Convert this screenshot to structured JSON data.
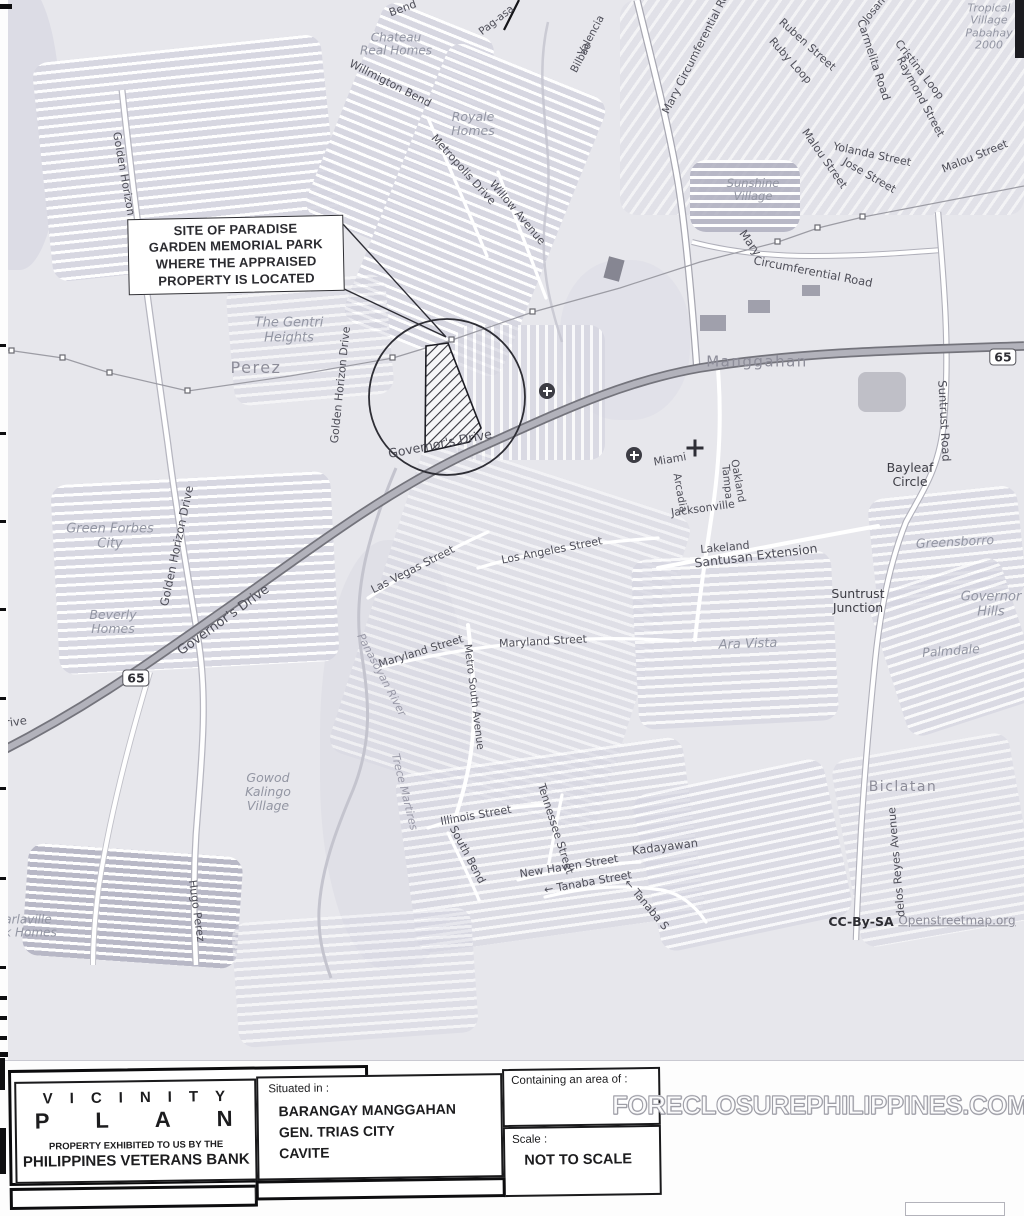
{
  "map": {
    "callout": {
      "lines": [
        "SITE OF PARADISE",
        "GARDEN MEMORIAL PARK",
        "WHERE THE APPRAISED",
        "PROPERTY IS LOCATED"
      ]
    },
    "labels": [
      {
        "t": "Bend",
        "x": 403,
        "y": 9,
        "r": -20,
        "s": 11,
        "c": "st"
      },
      {
        "t": "Chateau\nReal Homes",
        "x": 396,
        "y": 45,
        "r": 0,
        "s": 12,
        "c": "vil"
      },
      {
        "t": "Willmigton Bend",
        "x": 390,
        "y": 84,
        "r": 27,
        "s": 11,
        "c": "st"
      },
      {
        "t": "Pag-asa",
        "x": 497,
        "y": 21,
        "r": -38,
        "s": 10.5,
        "c": "st"
      },
      {
        "t": "Valencia",
        "x": 592,
        "y": 36,
        "r": -62,
        "s": 10.5,
        "c": "st"
      },
      {
        "t": "Bilbao",
        "x": 582,
        "y": 58,
        "r": -62,
        "s": 10.5,
        "c": "st"
      },
      {
        "t": "Royale\nHomes",
        "x": 473,
        "y": 124,
        "r": 0,
        "s": 12.5,
        "c": "vil"
      },
      {
        "t": "Metropolis Drive",
        "x": 463,
        "y": 170,
        "r": 48,
        "s": 11,
        "c": "st"
      },
      {
        "t": "Willow Avenue",
        "x": 517,
        "y": 213,
        "r": 50,
        "s": 11,
        "c": "st"
      },
      {
        "t": "Mary Circumferential Road",
        "x": 699,
        "y": 48,
        "r": -63,
        "s": 11,
        "c": "st"
      },
      {
        "t": "Josane",
        "x": 877,
        "y": 8,
        "r": -50,
        "s": 10.5,
        "c": "st"
      },
      {
        "t": "Ruben Street",
        "x": 807,
        "y": 45,
        "r": 42,
        "s": 11,
        "c": "st"
      },
      {
        "t": "Ruby Loop",
        "x": 790,
        "y": 61,
        "r": 48,
        "s": 11,
        "c": "st"
      },
      {
        "t": "Carmelita Road",
        "x": 873,
        "y": 60,
        "r": 72,
        "s": 11,
        "c": "st"
      },
      {
        "t": "Cristina Loop",
        "x": 919,
        "y": 70,
        "r": 52,
        "s": 11,
        "c": "st"
      },
      {
        "t": "Raymond Street",
        "x": 920,
        "y": 97,
        "r": 62,
        "s": 11,
        "c": "st"
      },
      {
        "t": "Tropical\nVillage\nPabahay\n2000",
        "x": 989,
        "y": 27,
        "r": 0,
        "s": 11,
        "c": "vil"
      },
      {
        "t": "Malou Street",
        "x": 824,
        "y": 159,
        "r": 55,
        "s": 11,
        "c": "st"
      },
      {
        "t": "Yolanda Street",
        "x": 872,
        "y": 155,
        "r": 12,
        "s": 11,
        "c": "st"
      },
      {
        "t": "Jose Street",
        "x": 869,
        "y": 176,
        "r": 30,
        "s": 11,
        "c": "st"
      },
      {
        "t": "Malou Street",
        "x": 975,
        "y": 157,
        "r": -22,
        "s": 11,
        "c": "st"
      },
      {
        "t": "Sunshine\nVillage",
        "x": 753,
        "y": 190,
        "r": 0,
        "s": 11.5,
        "c": "vil"
      },
      {
        "t": "Golden Horizon Drive",
        "x": 126,
        "y": 190,
        "r": 80,
        "s": 11,
        "c": "st"
      },
      {
        "t": "Perez",
        "x": 256,
        "y": 368,
        "r": 0,
        "s": 16,
        "c": "pl"
      },
      {
        "t": "The Gentri\nHeights",
        "x": 289,
        "y": 331,
        "r": 0,
        "s": 13,
        "c": "vil"
      },
      {
        "t": "Golden Horizon Drive",
        "x": 341,
        "y": 385,
        "r": -84,
        "s": 11,
        "c": "st"
      },
      {
        "t": "Mary",
        "x": 750,
        "y": 243,
        "r": 55,
        "s": 11.5,
        "c": "st"
      },
      {
        "t": "Circumferential Road",
        "x": 813,
        "y": 272,
        "r": 11,
        "s": 11.5,
        "c": "st"
      },
      {
        "t": "Manggahan",
        "x": 757,
        "y": 362,
        "r": 0,
        "s": 15,
        "c": "pl"
      },
      {
        "t": "Suntrust Road",
        "x": 944,
        "y": 421,
        "r": 87,
        "s": 11.5,
        "c": "st"
      },
      {
        "t": "Bayleaf\nCircle",
        "x": 910,
        "y": 475,
        "r": 0,
        "s": 12.5,
        "c": "drk"
      },
      {
        "t": "Miami",
        "x": 670,
        "y": 460,
        "r": -10,
        "s": 11,
        "c": "st"
      },
      {
        "t": "Oakland",
        "x": 737,
        "y": 481,
        "r": 80,
        "s": 10.5,
        "c": "st"
      },
      {
        "t": "Tampa",
        "x": 726,
        "y": 482,
        "r": 84,
        "s": 10.5,
        "c": "st"
      },
      {
        "t": "Arcadia",
        "x": 679,
        "y": 493,
        "r": 80,
        "s": 10.5,
        "c": "st"
      },
      {
        "t": "Jacksonville",
        "x": 703,
        "y": 509,
        "r": -8,
        "s": 11,
        "c": "st"
      },
      {
        "t": "Lakeland",
        "x": 725,
        "y": 548,
        "r": -5,
        "s": 11,
        "c": "st"
      },
      {
        "t": "Santusan Extension",
        "x": 756,
        "y": 556,
        "r": -7,
        "s": 12.5,
        "c": "st"
      },
      {
        "t": "Greensborro",
        "x": 955,
        "y": 542,
        "r": -3,
        "s": 12.5,
        "c": "vil"
      },
      {
        "t": "Governor's Drive",
        "x": 440,
        "y": 444,
        "r": -11,
        "s": 12.5,
        "c": "st"
      },
      {
        "t": "Governor's Drive",
        "x": 224,
        "y": 621,
        "r": -36,
        "s": 13,
        "c": "st"
      },
      {
        "t": "Golden Horizon Drive",
        "x": 177,
        "y": 546,
        "r": -78,
        "s": 11.5,
        "c": "st"
      },
      {
        "t": "Green Forbes\nCity",
        "x": 110,
        "y": 537,
        "r": 0,
        "s": 13,
        "c": "vil"
      },
      {
        "t": "Beverly\nHomes",
        "x": 113,
        "y": 622,
        "r": 0,
        "s": 12.5,
        "c": "vil"
      },
      {
        "t": "Las Vegas Street",
        "x": 413,
        "y": 570,
        "r": -27,
        "s": 11,
        "c": "st"
      },
      {
        "t": "Los Angeles Street",
        "x": 552,
        "y": 551,
        "r": -11,
        "s": 11,
        "c": "st"
      },
      {
        "t": "Maryland Street",
        "x": 421,
        "y": 652,
        "r": -17,
        "s": 11,
        "c": "st"
      },
      {
        "t": "Maryland Street",
        "x": 543,
        "y": 642,
        "r": -3,
        "s": 11,
        "c": "st"
      },
      {
        "t": "Panasoyan River",
        "x": 381,
        "y": 675,
        "r": 62,
        "s": 11,
        "c": "riv"
      },
      {
        "t": "Metro South Avenue",
        "x": 473,
        "y": 697,
        "r": 83,
        "s": 10.5,
        "c": "st"
      },
      {
        "t": "Suntrust\nJunction",
        "x": 858,
        "y": 601,
        "r": 0,
        "s": 12.5,
        "c": "drk"
      },
      {
        "t": "Governor\nHills",
        "x": 991,
        "y": 605,
        "r": 0,
        "s": 13,
        "c": "vil"
      },
      {
        "t": "Ara Vista",
        "x": 748,
        "y": 645,
        "r": -2,
        "s": 13,
        "c": "vil"
      },
      {
        "t": "Palmdale",
        "x": 951,
        "y": 651,
        "r": -4,
        "s": 12.5,
        "c": "vil"
      },
      {
        "t": "Gowod\nKalingo\nVillage",
        "x": 268,
        "y": 792,
        "r": 0,
        "s": 12.5,
        "c": "vil"
      },
      {
        "t": "Trece Martires",
        "x": 404,
        "y": 792,
        "r": 76,
        "s": 11,
        "c": "riv"
      },
      {
        "t": "Illinois Street",
        "x": 476,
        "y": 816,
        "r": -10,
        "s": 11,
        "c": "st"
      },
      {
        "t": "South Bend",
        "x": 467,
        "y": 855,
        "r": 62,
        "s": 11,
        "c": "st"
      },
      {
        "t": "Tennessee Street",
        "x": 555,
        "y": 829,
        "r": 72,
        "s": 11,
        "c": "st"
      },
      {
        "t": "New Haven Street",
        "x": 569,
        "y": 867,
        "r": -9,
        "s": 11,
        "c": "st"
      },
      {
        "t": "← Tanaba Street",
        "x": 588,
        "y": 883,
        "r": -10,
        "s": 11,
        "c": "st"
      },
      {
        "t": "Kadayawan",
        "x": 665,
        "y": 847,
        "r": -7,
        "s": 11.5,
        "c": "st"
      },
      {
        "t": "← Tanaba S",
        "x": 646,
        "y": 905,
        "r": 50,
        "s": 11,
        "c": "st"
      },
      {
        "t": "Biclatan",
        "x": 903,
        "y": 788,
        "r": 0,
        "s": 14,
        "c": "pl"
      },
      {
        "t": "delos Reyes Avenue",
        "x": 897,
        "y": 862,
        "r": -95,
        "s": 11,
        "c": "st"
      },
      {
        "t": "Hugo Perez",
        "x": 196,
        "y": 911,
        "r": 82,
        "s": 11,
        "c": "st"
      },
      {
        "t": "rive",
        "x": 16,
        "y": 722,
        "r": -8,
        "s": 11.5,
        "c": "st"
      },
      {
        "t": "arlaville\nrk Homes",
        "x": 28,
        "y": 927,
        "r": 0,
        "s": 12,
        "c": "vil"
      }
    ],
    "route_shields": [
      {
        "label": "65",
        "x": 136,
        "y": 678
      },
      {
        "label": "65",
        "x": 1003,
        "y": 357
      }
    ],
    "attribution": {
      "license": "CC-By-SA",
      "source": "Openstreetmap.org"
    }
  },
  "title_block": {
    "title_word1": "VICINITY",
    "title_word2": "PLAN",
    "subtitle_line1": "PROPERTY EXHIBITED TO US BY THE",
    "subtitle_line2": "PHILIPPINES VETERANS BANK",
    "situated_label": "Situated in :",
    "situated_lines": [
      "BARANGAY MANGGAHAN",
      "GEN. TRIAS CITY",
      "CAVITE"
    ],
    "area_label": "Containing an area of :",
    "scale_label": "Scale :",
    "scale_value": "NOT TO SCALE"
  },
  "watermark": "FORECLOSUREPHILIPPINES.COM",
  "colors": {
    "map_base": "#e7e7ec",
    "street_text": "#4f4f59",
    "place_text": "#8d8d99",
    "village_text": "#9396a3",
    "ink": "#1a1a1c"
  }
}
